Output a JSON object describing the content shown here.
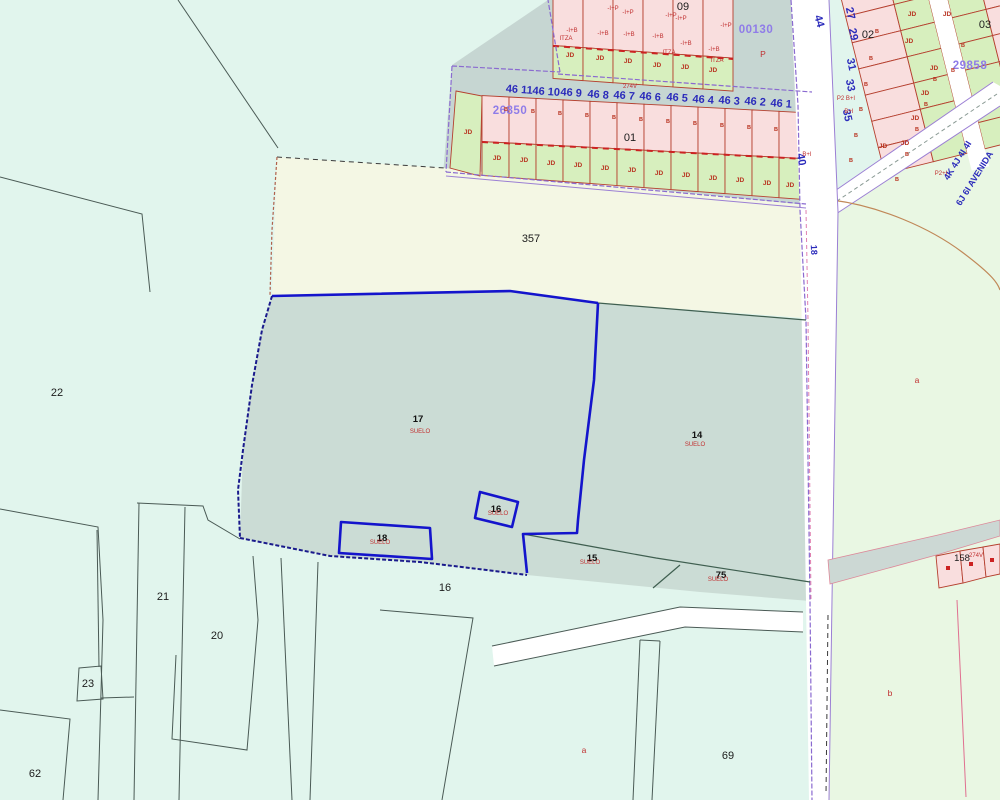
{
  "app": {
    "type": "cadastral-map-viewer"
  },
  "palette": {
    "background": "#e1f5ed",
    "cream_parcel": "#f4f7e4",
    "selected_teal": "#cbdcd5",
    "green_area": "#e9f7e3",
    "pink_cell": "#f9dede",
    "green_cell": "#d7efbe",
    "gray_road": "#c6d6d2",
    "white_road": "#ffffff",
    "selection_blue": "#1414cc",
    "purple_edge": "#8a6ad0",
    "cell_border_red": "#b5402f",
    "label_red": "#c23030",
    "label_blue": "#2b2bbb",
    "label_violet": "#8f7ce8"
  },
  "map": {
    "labels": [
      {
        "n": "block-09",
        "t": "09",
        "x": 683,
        "y": 10,
        "c": "blk"
      },
      {
        "n": "block-01",
        "t": "01",
        "x": 630,
        "y": 141,
        "c": "blk"
      },
      {
        "n": "block-02",
        "t": "02",
        "x": 868,
        "y": 38,
        "c": "blk"
      },
      {
        "n": "block-03",
        "t": "03",
        "x": 985,
        "y": 28,
        "c": "blk"
      },
      {
        "n": "parcel-357",
        "t": "357",
        "x": 531,
        "y": 242,
        "c": "blk"
      },
      {
        "n": "parcel-22",
        "t": "22",
        "x": 57,
        "y": 396,
        "c": "blk"
      },
      {
        "n": "parcel-21",
        "t": "21",
        "x": 163,
        "y": 600,
        "c": "blk"
      },
      {
        "n": "parcel-20",
        "t": "20",
        "x": 217,
        "y": 639,
        "c": "blk"
      },
      {
        "n": "parcel-23",
        "t": "23",
        "x": 88,
        "y": 687,
        "c": "blk"
      },
      {
        "n": "parcel-62",
        "t": "62",
        "x": 35,
        "y": 777,
        "c": "blk"
      },
      {
        "n": "parcel-16-lower",
        "t": "16",
        "x": 445,
        "y": 591,
        "c": "blk"
      },
      {
        "n": "parcel-69",
        "t": "69",
        "x": 728,
        "y": 759,
        "c": "blk"
      },
      {
        "n": "parcel-158",
        "t": "158",
        "x": 962,
        "y": 561,
        "c": "bs"
      },
      {
        "n": "parcel-17",
        "t": "17",
        "x": 418,
        "y": 422,
        "c": "pn"
      },
      {
        "n": "parcel-17-suelo",
        "t": "SUELO",
        "x": 420,
        "y": 433,
        "c": "su"
      },
      {
        "n": "parcel-14",
        "t": "14",
        "x": 697,
        "y": 438,
        "c": "pn"
      },
      {
        "n": "parcel-14-suelo",
        "t": "SUELO",
        "x": 695,
        "y": 446,
        "c": "su"
      },
      {
        "n": "parcel-16",
        "t": "16",
        "x": 496,
        "y": 512,
        "c": "pn"
      },
      {
        "n": "parcel-16-suelo",
        "t": "SUELO",
        "x": 498,
        "y": 515,
        "c": "su"
      },
      {
        "n": "parcel-18",
        "t": "18",
        "x": 382,
        "y": 541,
        "c": "pn"
      },
      {
        "n": "parcel-18-suelo",
        "t": "SUELO",
        "x": 380,
        "y": 544,
        "c": "su"
      },
      {
        "n": "parcel-15",
        "t": "15",
        "x": 592,
        "y": 561,
        "c": "pn"
      },
      {
        "n": "parcel-15-suelo",
        "t": "SUELO",
        "x": 590,
        "y": 564,
        "c": "su"
      },
      {
        "n": "parcel-75",
        "t": "75",
        "x": 721,
        "y": 578,
        "c": "pn"
      },
      {
        "n": "parcel-75-suelo",
        "t": "SUELO",
        "x": 718,
        "y": 581,
        "c": "su"
      },
      {
        "n": "code-00130",
        "t": "00130",
        "x": 756,
        "y": 33,
        "c": "cd"
      },
      {
        "n": "code-26850",
        "t": "26850",
        "x": 510,
        "y": 114,
        "c": "cd"
      },
      {
        "n": "code-29858",
        "t": "29858",
        "x": 970,
        "y": 69,
        "c": "cd"
      },
      {
        "n": "house-46-11",
        "t": "46 11",
        "x": 519,
        "y": 93,
        "c": "bn",
        "r": 4
      },
      {
        "n": "house-46-10",
        "t": "46 10",
        "x": 546,
        "y": 95,
        "c": "bn",
        "r": 4
      },
      {
        "n": "house-46-9",
        "t": "46 9",
        "x": 571,
        "y": 96,
        "c": "bn",
        "r": 4
      },
      {
        "n": "house-46-8",
        "t": "46 8",
        "x": 598,
        "y": 98,
        "c": "bn",
        "r": 4
      },
      {
        "n": "house-46-7",
        "t": "46 7",
        "x": 624,
        "y": 99,
        "c": "bn",
        "r": 4
      },
      {
        "n": "house-46-6",
        "t": "46 6",
        "x": 650,
        "y": 100,
        "c": "bn",
        "r": 4
      },
      {
        "n": "house-46-5",
        "t": "46 5",
        "x": 677,
        "y": 101,
        "c": "bn",
        "r": 4
      },
      {
        "n": "house-46-4",
        "t": "46 4",
        "x": 703,
        "y": 103,
        "c": "bn",
        "r": 4
      },
      {
        "n": "house-46-3",
        "t": "46 3",
        "x": 729,
        "y": 104,
        "c": "bn",
        "r": 4
      },
      {
        "n": "house-46-2",
        "t": "46 2",
        "x": 755,
        "y": 105,
        "c": "bn",
        "r": 4
      },
      {
        "n": "house-46-1",
        "t": "46 1",
        "x": 781,
        "y": 107,
        "c": "bn",
        "r": 4
      },
      {
        "n": "street-44",
        "t": "44",
        "x": 816,
        "y": 22,
        "c": "bn",
        "r": 75
      },
      {
        "n": "street-27",
        "t": "27",
        "x": 847,
        "y": 14,
        "c": "bn",
        "r": 78
      },
      {
        "n": "street-29",
        "t": "29",
        "x": 850,
        "y": 35,
        "c": "bn",
        "r": 78
      },
      {
        "n": "street-31",
        "t": "31",
        "x": 848,
        "y": 65,
        "c": "bn",
        "r": 78
      },
      {
        "n": "street-33",
        "t": "33",
        "x": 847,
        "y": 86,
        "c": "bn",
        "r": 78
      },
      {
        "n": "street-35",
        "t": "35",
        "x": 844,
        "y": 116,
        "c": "bn",
        "r": 78
      },
      {
        "n": "street-40",
        "t": "40",
        "x": 798,
        "y": 160,
        "c": "bn",
        "r": 80
      },
      {
        "n": "street-18",
        "t": "18",
        "x": 811,
        "y": 250,
        "c": "bn2",
        "r": 87
      },
      {
        "n": "avenue-4k",
        "t": "4K 4J 4I 4I",
        "x": 960,
        "y": 162,
        "c": "bn2",
        "r": -58
      },
      {
        "n": "avenue-6j",
        "t": "6J 6I AVENIDA",
        "x": 977,
        "y": 180,
        "c": "bn2",
        "r": -58
      },
      {
        "n": "jd-label",
        "t": "JD",
        "x": 468,
        "y": 134,
        "c": "jd"
      },
      {
        "n": "jd-label",
        "t": "JD",
        "x": 497,
        "y": 160,
        "c": "jd"
      },
      {
        "n": "jd-label",
        "t": "JD",
        "x": 524,
        "y": 162,
        "c": "jd"
      },
      {
        "n": "jd-label",
        "t": "JD",
        "x": 551,
        "y": 165,
        "c": "jd"
      },
      {
        "n": "jd-label",
        "t": "JD",
        "x": 578,
        "y": 167,
        "c": "jd"
      },
      {
        "n": "jd-label",
        "t": "JD",
        "x": 605,
        "y": 170,
        "c": "jd"
      },
      {
        "n": "jd-label",
        "t": "JD",
        "x": 632,
        "y": 172,
        "c": "jd"
      },
      {
        "n": "jd-label",
        "t": "JD",
        "x": 659,
        "y": 175,
        "c": "jd"
      },
      {
        "n": "jd-label",
        "t": "JD",
        "x": 686,
        "y": 177,
        "c": "jd"
      },
      {
        "n": "jd-label",
        "t": "JD",
        "x": 713,
        "y": 180,
        "c": "jd"
      },
      {
        "n": "jd-label",
        "t": "JD",
        "x": 740,
        "y": 182,
        "c": "jd"
      },
      {
        "n": "jd-label",
        "t": "JD",
        "x": 767,
        "y": 185,
        "c": "jd"
      },
      {
        "n": "jd-label",
        "t": "JD",
        "x": 790,
        "y": 187,
        "c": "jd"
      },
      {
        "n": "jd-label",
        "t": "JD",
        "x": 570,
        "y": 57,
        "c": "jd"
      },
      {
        "n": "jd-label",
        "t": "JD",
        "x": 600,
        "y": 60,
        "c": "jd"
      },
      {
        "n": "jd-label",
        "t": "JD",
        "x": 628,
        "y": 63,
        "c": "jd"
      },
      {
        "n": "jd-label",
        "t": "JD",
        "x": 657,
        "y": 67,
        "c": "jd"
      },
      {
        "n": "jd-label",
        "t": "JD",
        "x": 685,
        "y": 69,
        "c": "jd"
      },
      {
        "n": "jd-label",
        "t": "JD",
        "x": 713,
        "y": 72,
        "c": "jd"
      },
      {
        "n": "jd-label",
        "t": "JD",
        "x": 912,
        "y": 16,
        "c": "jd"
      },
      {
        "n": "jd-label",
        "t": "JD",
        "x": 947,
        "y": 16,
        "c": "jd"
      },
      {
        "n": "jd-label",
        "t": "JD",
        "x": 909,
        "y": 43,
        "c": "jd"
      },
      {
        "n": "jd-label",
        "t": "JD",
        "x": 934,
        "y": 70,
        "c": "jd"
      },
      {
        "n": "jd-label",
        "t": "JD",
        "x": 925,
        "y": 95,
        "c": "jd"
      },
      {
        "n": "jd-label",
        "t": "JD",
        "x": 915,
        "y": 120,
        "c": "jd"
      },
      {
        "n": "jd-label",
        "t": "JD",
        "x": 905,
        "y": 145,
        "c": "jd"
      },
      {
        "n": "jd-label",
        "t": "JD",
        "x": 883,
        "y": 148,
        "c": "jd"
      },
      {
        "n": "b-mark",
        "t": "B",
        "x": 506,
        "y": 111,
        "c": "bm"
      },
      {
        "n": "b-mark",
        "t": "B",
        "x": 533,
        "y": 113,
        "c": "bm"
      },
      {
        "n": "b-mark",
        "t": "B",
        "x": 560,
        "y": 115,
        "c": "bm"
      },
      {
        "n": "b-mark",
        "t": "B",
        "x": 587,
        "y": 117,
        "c": "bm"
      },
      {
        "n": "b-mark",
        "t": "B",
        "x": 614,
        "y": 119,
        "c": "bm"
      },
      {
        "n": "b-mark",
        "t": "B",
        "x": 641,
        "y": 121,
        "c": "bm"
      },
      {
        "n": "b-mark",
        "t": "B",
        "x": 668,
        "y": 123,
        "c": "bm"
      },
      {
        "n": "b-mark",
        "t": "B",
        "x": 695,
        "y": 125,
        "c": "bm"
      },
      {
        "n": "b-mark",
        "t": "B",
        "x": 722,
        "y": 127,
        "c": "bm"
      },
      {
        "n": "b-mark",
        "t": "B",
        "x": 749,
        "y": 129,
        "c": "bm"
      },
      {
        "n": "b-mark",
        "t": "B",
        "x": 776,
        "y": 131,
        "c": "bm"
      },
      {
        "n": "b-mark",
        "t": "B",
        "x": 877,
        "y": 33,
        "c": "bm"
      },
      {
        "n": "b-mark",
        "t": "B",
        "x": 871,
        "y": 60,
        "c": "bm"
      },
      {
        "n": "b-mark",
        "t": "B",
        "x": 866,
        "y": 86,
        "c": "bm"
      },
      {
        "n": "b-mark",
        "t": "B",
        "x": 861,
        "y": 111,
        "c": "bm"
      },
      {
        "n": "b-mark",
        "t": "B",
        "x": 856,
        "y": 137,
        "c": "bm"
      },
      {
        "n": "b-mark",
        "t": "B",
        "x": 851,
        "y": 162,
        "c": "bm"
      },
      {
        "n": "b-mark",
        "t": "B",
        "x": 963,
        "y": 47,
        "c": "bm"
      },
      {
        "n": "b-mark",
        "t": "B",
        "x": 953,
        "y": 72,
        "c": "bm"
      },
      {
        "n": "b-mark",
        "t": "B",
        "x": 935,
        "y": 81,
        "c": "bm"
      },
      {
        "n": "b-mark",
        "t": "B",
        "x": 926,
        "y": 106,
        "c": "bm"
      },
      {
        "n": "b-mark",
        "t": "B",
        "x": 917,
        "y": 131,
        "c": "bm"
      },
      {
        "n": "b-mark",
        "t": "B",
        "x": 907,
        "y": 156,
        "c": "bm"
      },
      {
        "n": "b-mark",
        "t": "B",
        "x": 897,
        "y": 181,
        "c": "bm"
      },
      {
        "n": "ann-p",
        "t": "P",
        "x": 763,
        "y": 57,
        "c": "rl"
      },
      {
        "n": "ann-itza",
        "t": "ITZA",
        "x": 566,
        "y": 40,
        "c": "rt"
      },
      {
        "n": "ann-itza",
        "t": "ITZA",
        "x": 669,
        "y": 54,
        "c": "rt"
      },
      {
        "n": "ann-itza",
        "t": "ITZA",
        "x": 717,
        "y": 62,
        "c": "rt"
      },
      {
        "n": "ann-274v",
        "t": "274V",
        "x": 630,
        "y": 88,
        "c": "rt"
      },
      {
        "n": "ann-274v",
        "t": "274V",
        "x": 976,
        "y": 557,
        "c": "rt"
      },
      {
        "n": "ann-iplusb",
        "t": "-I+B",
        "x": 572,
        "y": 32,
        "c": "rt"
      },
      {
        "n": "ann-iplusb",
        "t": "-I+B",
        "x": 603,
        "y": 35,
        "c": "rt"
      },
      {
        "n": "ann-iplusb",
        "t": "-I+B",
        "x": 629,
        "y": 36,
        "c": "rt"
      },
      {
        "n": "ann-iplusb",
        "t": "-I+B",
        "x": 658,
        "y": 38,
        "c": "rt"
      },
      {
        "n": "ann-iplusb",
        "t": "-I+B",
        "x": 686,
        "y": 45,
        "c": "rt"
      },
      {
        "n": "ann-iplusb",
        "t": "-I+B",
        "x": 714,
        "y": 51,
        "c": "rt"
      },
      {
        "n": "ann-iplusp",
        "t": "-I+P",
        "x": 613,
        "y": 10,
        "c": "rt"
      },
      {
        "n": "ann-iplusp",
        "t": "-I+P",
        "x": 628,
        "y": 14,
        "c": "rt"
      },
      {
        "n": "ann-iplusp",
        "t": "-I+P",
        "x": 671,
        "y": 17,
        "c": "rt"
      },
      {
        "n": "ann-iplusp",
        "t": "-I+P",
        "x": 681,
        "y": 20,
        "c": "rt"
      },
      {
        "n": "ann-iplusp",
        "t": "-I+P",
        "x": 726,
        "y": 27,
        "c": "rt"
      },
      {
        "n": "ann-p2bi",
        "t": "P2 B+I",
        "x": 846,
        "y": 100,
        "c": "rt"
      },
      {
        "n": "ann-bi",
        "t": "B+I",
        "x": 849,
        "y": 113,
        "c": "rt"
      },
      {
        "n": "ann-p2i",
        "t": "P2+I",
        "x": 941,
        "y": 175,
        "c": "rt"
      },
      {
        "n": "ann-bi",
        "t": "B+I",
        "x": 807,
        "y": 156,
        "c": "rt"
      },
      {
        "n": "subparcel-a",
        "t": "a",
        "x": 917,
        "y": 383,
        "c": "rl"
      },
      {
        "n": "subparcel-a",
        "t": "a",
        "x": 584,
        "y": 753,
        "c": "rl"
      },
      {
        "n": "subparcel-b",
        "t": "b",
        "x": 890,
        "y": 696,
        "c": "rl"
      }
    ]
  }
}
